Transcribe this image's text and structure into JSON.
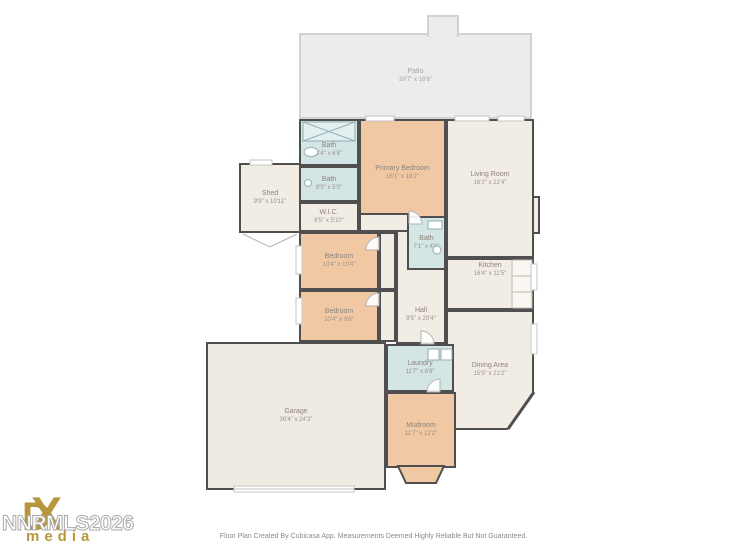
{
  "colors": {
    "wall": "#4f4f4f",
    "room_neutral": "#f2ede4",
    "room_bedroom": "#f0c8a4",
    "room_wet": "#d3e5e5",
    "patio": "#ececec",
    "logo_gold": "#b6973e"
  },
  "rooms": [
    {
      "name": "Patio",
      "dims": "39'7\" x 18'6\""
    },
    {
      "name": "Bath",
      "dims": "8'4\" x 6'8\""
    },
    {
      "name": "Bath",
      "dims": "8'5\" x 5'0\""
    },
    {
      "name": "W.I.C.",
      "dims": "8'5\" x 5'10\""
    },
    {
      "name": "Primary Bedroom",
      "dims": "16'1\" x 18'2\""
    },
    {
      "name": "Living Room",
      "dims": "16'2\" x 22'4\""
    },
    {
      "name": "Shed",
      "dims": "9'9\" x 10'11\""
    },
    {
      "name": "Bath",
      "dims": "7'1\" x 4'6\""
    },
    {
      "name": "Bedroom",
      "dims": "10'4\" x 10'4\""
    },
    {
      "name": "Bedroom",
      "dims": "10'4\" x 9'8\""
    },
    {
      "name": "Hall",
      "dims": "9'5\" x 20'4\""
    },
    {
      "name": "Kitchen",
      "dims": "16'4\" x 11'5\""
    },
    {
      "name": "Dining Area",
      "dims": "15'5\" x 21'2\""
    },
    {
      "name": "Laundry",
      "dims": "11'7\" x 6'8\""
    },
    {
      "name": "Garage",
      "dims": "30'4\" x 24'3\""
    },
    {
      "name": "Mudroom",
      "dims": "11'7\" x 12'2\""
    }
  ],
  "watermark": {
    "logo_d": "D",
    "logo_x": "X",
    "logo_subtext": "media",
    "mls_text": "NNRMLS2026"
  },
  "footer": {
    "disclaimer": "Floor Plan Created By Cubicasa App. Measurements Deemed Highly Reliable But Not Guaranteed."
  }
}
